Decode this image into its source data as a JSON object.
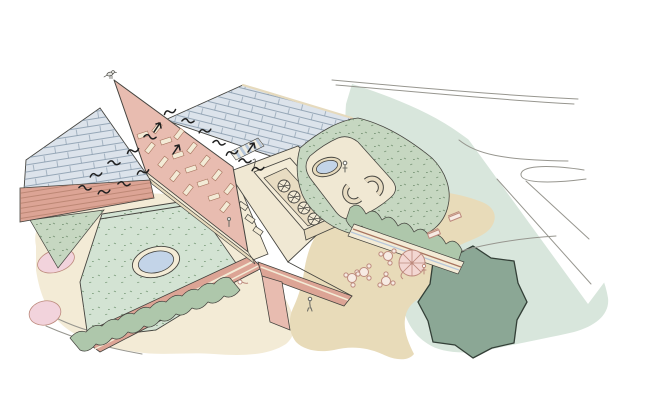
{
  "illustration": {
    "kind": "hand-drawn architectural aerial sketch",
    "background": "#ffffff"
  },
  "palette": {
    "ink": "#45443f",
    "roadLine": "#97968f",
    "bird": "#202020",
    "figure": "#6f6f68",
    "roofTile": "#dce3eb",
    "tileLine": "#7f93a6",
    "clerestoryBlue": "#b7c7da",
    "clerestoryBg": "#f1eee2",
    "gutterRed": "#a66a5c",
    "brick": "#e8bcb0",
    "brickBand": "#dca495",
    "brickLine": "#a8745f",
    "cream": "#f3ebd6",
    "creamShade": "#e6dabd",
    "deck": "#f0e8d3",
    "tray": "#e8dcc2",
    "sedum": "#c6d7c1",
    "sedumSpeck": "#7c987a",
    "courtyard": "#d3e3d3",
    "courtSpeck": "#84a384",
    "hedge": "#aec7ab",
    "lawn": "#d8e6dc",
    "sand": "#e8dbb9",
    "tree": "#8ba795",
    "treeLine": "#333f37",
    "water": "#c3d4e8",
    "pinkPlanter": "#f2d3dc",
    "furniture": "#bd8a7d",
    "furnitureFill": "#f7ebe4",
    "parasolFill": "#f3d7d2",
    "paper": "#ffffff"
  },
  "scene": {
    "elements": [
      {
        "name": "tiled-roof-left",
        "count": 1
      },
      {
        "name": "tiled-roof-right",
        "count": 1
      },
      {
        "name": "brick-gable-tower",
        "count": 1
      },
      {
        "name": "tower-window",
        "count": 17
      },
      {
        "name": "swift-bird",
        "count": 18
      },
      {
        "name": "perched-bird",
        "count": 1
      },
      {
        "name": "rooftop-plant-room",
        "count": 1
      },
      {
        "name": "ventilation-fan",
        "count": 4
      },
      {
        "name": "roof-terrace",
        "count": 1
      },
      {
        "name": "oval-skylight",
        "count": 1
      },
      {
        "name": "curved-bench",
        "count": 2
      },
      {
        "name": "sedum-green-roof",
        "count": 3
      },
      {
        "name": "courtyard-lawn",
        "count": 1
      },
      {
        "name": "pond",
        "count": 1
      },
      {
        "name": "pink-planter",
        "count": 2
      },
      {
        "name": "hedge-band",
        "count": 2
      },
      {
        "name": "sand-terrace",
        "count": 1
      },
      {
        "name": "parasol",
        "count": 1
      },
      {
        "name": "cafe-table-set",
        "count": 4
      },
      {
        "name": "bench",
        "count": 2
      },
      {
        "name": "tree-canopy",
        "count": 1
      },
      {
        "name": "lawn-area",
        "count": 1
      },
      {
        "name": "road-sketch-line",
        "count": 6
      },
      {
        "name": "person",
        "count": 4
      }
    ]
  }
}
